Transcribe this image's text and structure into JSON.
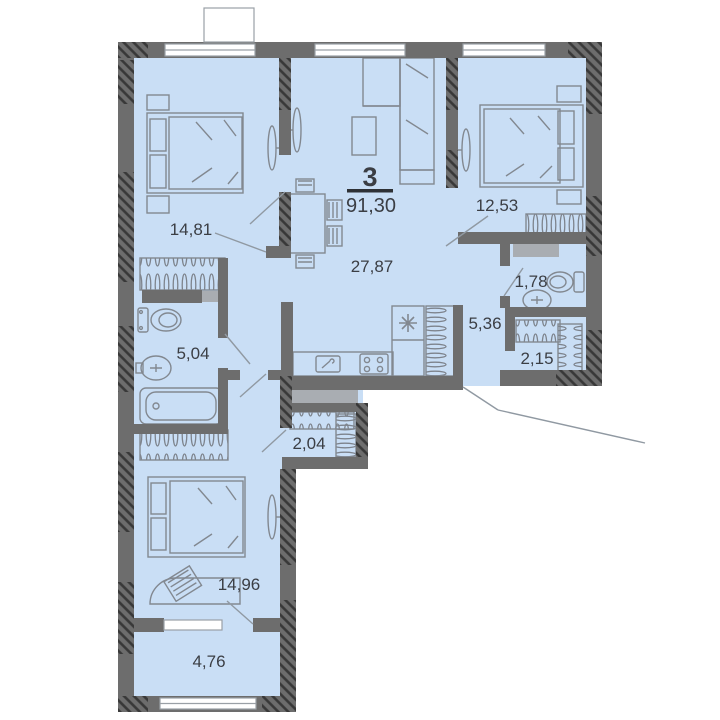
{
  "title": "Apartment floor plan",
  "apartment": {
    "number": "3",
    "total_area": "91,30"
  },
  "rooms": [
    {
      "name": "bedroom-top-left",
      "area": "14,81"
    },
    {
      "name": "bedroom-top-right",
      "area": "12,53"
    },
    {
      "name": "living-kitchen",
      "area": "27,87"
    },
    {
      "name": "hallway",
      "area": "5,36"
    },
    {
      "name": "wc",
      "area": "1,78"
    },
    {
      "name": "wardrobe-right",
      "area": "2,15"
    },
    {
      "name": "bathroom",
      "area": "5,04"
    },
    {
      "name": "wardrobe-lower",
      "area": "2,04"
    },
    {
      "name": "bedroom-bottom",
      "area": "14,96"
    },
    {
      "name": "balcony",
      "area": "4,76"
    }
  ],
  "colors": {
    "background": "#ffffff",
    "floor": "#c9def5",
    "wall": "#6d6d6d",
    "wall_hatch": "#383838",
    "furniture_stroke": "#828890",
    "slab": "#a9adb2",
    "text": "#3b3e44",
    "window": "#ffffff"
  }
}
